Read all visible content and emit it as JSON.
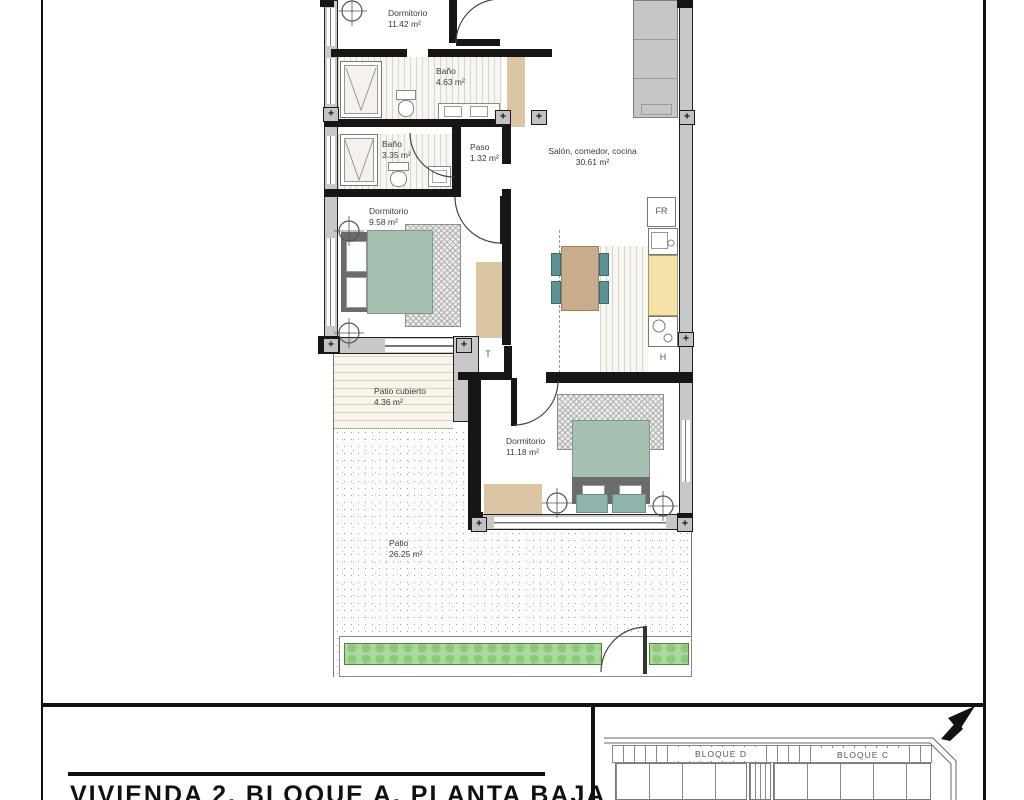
{
  "sheet": {
    "title": "VIVIENDA 2, BLOQUE A, PLANTA BAJA"
  },
  "rooms": [
    {
      "name": "Dormitorio",
      "area": "11.42 m²"
    },
    {
      "name": "Baño",
      "area": "4.63 m²"
    },
    {
      "name": "Baño",
      "area": "3.35 m²"
    },
    {
      "name": "Paso",
      "area": "1.32 m²"
    },
    {
      "name": "Salón, comedor, cocina",
      "area": "30.61 m²"
    },
    {
      "name": "Dormitorio",
      "area": "9.58 m²"
    },
    {
      "name": "Patio cubierto",
      "area": "4.36 m²"
    },
    {
      "name": "Dormitorio",
      "area": "11.18 m²"
    },
    {
      "name": "Patio",
      "area": "26.25 m²"
    }
  ],
  "appliances": {
    "fridge": "FR",
    "tank": "T",
    "hob": "H"
  },
  "symbols": {
    "column_plus": "+"
  },
  "site_plan": {
    "block_d": "BLOQUE D",
    "block_c": "BLOQUE C"
  },
  "colors": {
    "bed": "#a6c0b2",
    "headboard": "#6b6b6b",
    "chair": "#5d9193",
    "table": "#c7ad8c",
    "counter": "#f6e2a9",
    "rug_tan": "#dbc6a3",
    "hedge": "#abd999",
    "wall_exterior": "#c8c8c8",
    "wall_interior": "#161616"
  }
}
